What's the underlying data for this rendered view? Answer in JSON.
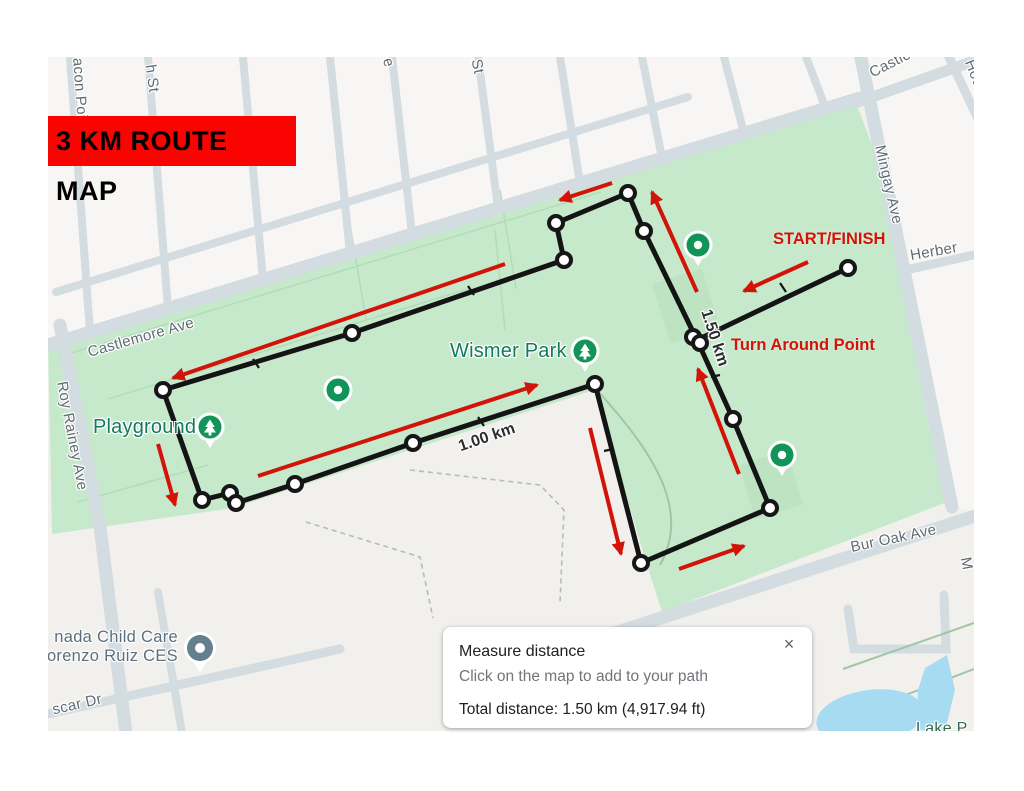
{
  "banner": {
    "text": "3 KM ROUTE MAP"
  },
  "labels": {
    "wismer_park": "Wismer Park",
    "playground": "Playground",
    "childcare_1": "nada Child Care",
    "childcare_2": "orenzo Ruiz CES",
    "lake_partial": "Lake P"
  },
  "route": {
    "start_finish": "START/FINISH",
    "turn_around": "Turn Around Point",
    "marker_150": "1.50 km",
    "marker_100": "1.00 km"
  },
  "streets": {
    "castlemore": "Castlemore Ave",
    "castle_partial": "Castle",
    "roy_rainey": "Roy Rainey Ave",
    "mingay": "Mingay Ave",
    "bur_oak": "Bur Oak Ave",
    "herbert": "Herber",
    "house_partial": "Hou",
    "beacon_partial": "acon Poin",
    "h_st": "h St",
    "e_partial": "e",
    "st_partial": "St",
    "oscar_dr": "scar Dr",
    "m_partial": "M"
  },
  "dialog": {
    "title": "Measure distance",
    "subtitle": "Click on the map to add to your path",
    "total": "Total distance: 1.50 km (4,917.94 ft)",
    "close": "×"
  },
  "colors": {
    "banner_red": "#f90400",
    "annotation_red": "#d21408",
    "route_black": "#141414",
    "park_green": "#c7e9cb",
    "water_blue": "#a6dbf2",
    "pin_green": "#119457",
    "poi_label_green": "#15795f",
    "road_grey": "#d3dce1"
  }
}
